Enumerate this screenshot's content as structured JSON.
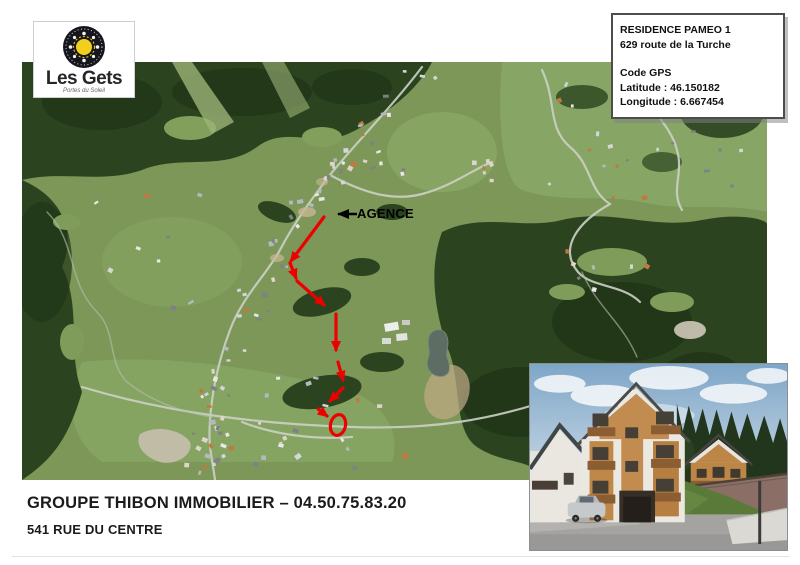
{
  "logo": {
    "title": "Les Gets",
    "tagline": "Portes du Soleil"
  },
  "info_box": {
    "residence": "RESIDENCE PAMEO 1",
    "address": "629 route de la Turche",
    "gps_heading": "Code GPS",
    "latitude": "Latitude : 46.150182",
    "longitude": "Longitude : 6.667454"
  },
  "map": {
    "agence_label": "AGENCE"
  },
  "footer": {
    "agency_line": "GROUPE THIBON IMMOBILIER – 04.50.75.83.20",
    "address_line": "541 RUE DU CENTRE"
  },
  "colors": {
    "route_red": "#ee0000",
    "arrow_black": "#000000",
    "map_meadow": "#7c9758",
    "map_forest": "#2b441f"
  }
}
